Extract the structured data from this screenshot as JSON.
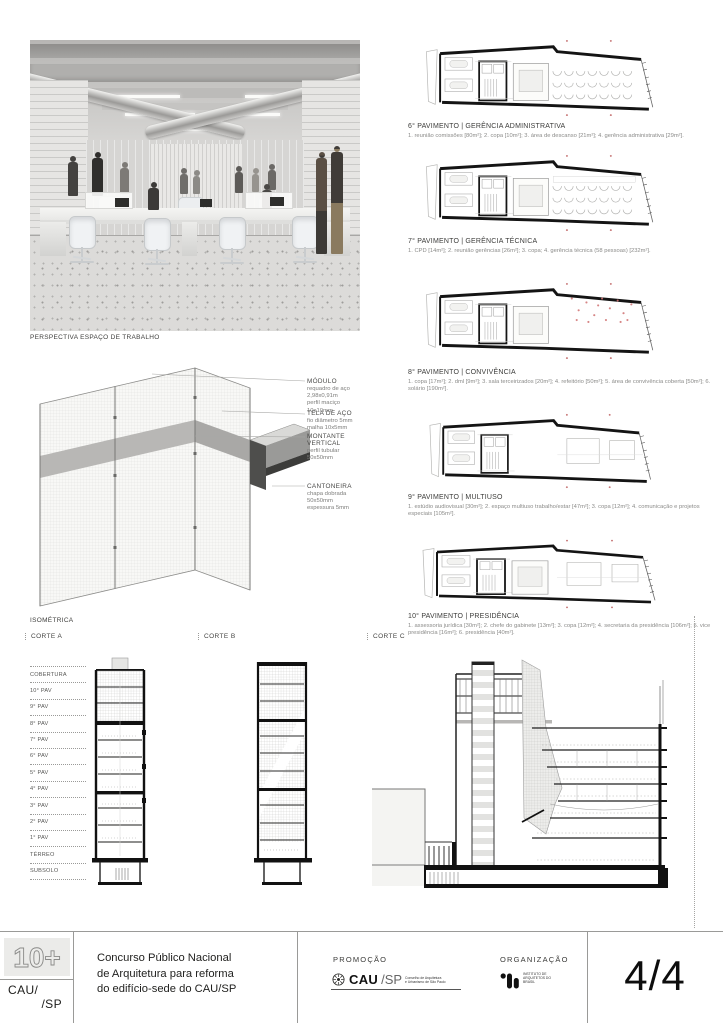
{
  "board": {
    "perspective_caption": "PERSPECTIVA ESPAÇO DE TRABALHO",
    "isometric_caption": "ISOMÉTRICA"
  },
  "isometric_annotations": [
    {
      "title": "MÓDULO",
      "body": "requadro de aço\n2,98x0,91m\nperfil maciço\n10x10mm"
    },
    {
      "title": "TELA DE AÇO",
      "body": "fio diâmetro 5mm\nmalha 10x5mm"
    },
    {
      "title": "MONTANTE\nVERTICAL",
      "body": "perfil tubular\n50x50mm"
    },
    {
      "title": "CANTONEIRA",
      "body": "chapa dobrada\n50x50mm\nespessura 5mm"
    }
  ],
  "plans": [
    {
      "title": "6° PAVIMENTO | GERÊNCIA ADMINISTRATIVA",
      "legend": "1. reunião comissões [80m²]; 2. copa [10m²]; 3. área de descanso [21m²]; 4. gerência administrativa [29m²]."
    },
    {
      "title": "7° PAVIMENTO | GERÊNCIA TÉCNICA",
      "legend": "1. CPD [14m²]; 2. reunião gerências [26m²]; 3. copa; 4. gerência técnica (58 pessoas) [232m²]."
    },
    {
      "title": "8° PAVIMENTO | CONVIVÊNCIA",
      "legend": "1. copa [17m²]; 2. dml [9m²]; 3. sala terceirizados [20m²]; 4. refeitório [50m²]; 5. área de convivência coberta [50m²]; 6. solário [190m²]."
    },
    {
      "title": "9° PAVIMENTO | MULTIUSO",
      "legend": "1. estúdio audiovisual [30m²]; 2. espaço multiuso trabalho/estar [47m²]; 3. copa [12m²]; 4. comunicação e projetos especiais [105m²]."
    },
    {
      "title": "10° PAVIMENTO | PRESIDÊNCIA",
      "legend": "1. assessoria jurídica [30m²]; 2. chefe do gabinete [13m²]; 3. copa [12m²]; 4. secretaria da presidência [106m²]; 5. vice presidência [16m²]; 6. presidência [40m²]."
    }
  ],
  "sections": {
    "corte_a": "CORTE A",
    "corte_b": "CORTE B",
    "corte_c": "CORTE C",
    "floors": [
      "COBERTURA",
      "10° PAV",
      "9° PAV",
      "8° PAV",
      "7° PAV",
      "6° PAV",
      "5° PAV",
      "4° PAV",
      "3° PAV",
      "2° PAV",
      "1° PAV",
      "TÉRREO",
      "SUBSOLO"
    ]
  },
  "footer": {
    "logo_top": "10+",
    "logo_line1": "CAU/",
    "logo_line2": "/SP",
    "title": "Concurso Público Nacional\nde Arquitetura para reforma\ndo edifício-sede do CAU/SP",
    "promo_label": "PROMOÇÃO",
    "promo_logo_cau": "CAU",
    "promo_logo_sp": "/SP",
    "promo_logo_sub": "Conselho de Arquitetura\ne Urbanismo de São Paulo",
    "org_label": "ORGANIZAÇÃO",
    "org_logo_sub": "INSTITUTO DE\nARQUITETOS DO\nBRASIL",
    "page_number": "4/4"
  },
  "colors": {
    "accent_red": "#c87878",
    "ink": "#1a1a1a",
    "line_gray": "#9a9a98",
    "panel_gray": "#ebebe9"
  }
}
